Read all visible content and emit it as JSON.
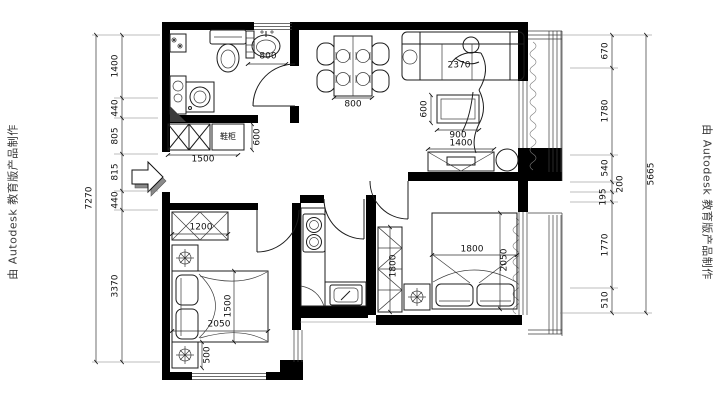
{
  "watermark": {
    "left": "由 Autodesk 教育版产品制作",
    "right": "由 Autodesk 教育版产品制作"
  },
  "dimensions": {
    "left_total": "7270",
    "left_chain": [
      "1400",
      "440",
      "805",
      "815",
      "440",
      "3370"
    ],
    "right_total": "5665",
    "right_chain": [
      "670",
      "1780",
      "540",
      "200",
      "195",
      "1770",
      "510"
    ],
    "interior": {
      "bath_basin_width": "800",
      "entry_cabinet_width": "1500",
      "entry_cabinet_depth": "600",
      "dining_table_width": "800",
      "sofa_length": "2370",
      "coffee_table_width": "900",
      "coffee_table_depth": "600",
      "tv_cabinet_width": "1400",
      "bedroom2_wardrobe_width": "1200",
      "bedroom2_bed_length": "2050",
      "bedroom2_bed_width": "1500",
      "bedroom2_nightstand_depth": "500",
      "master_wardrobe_length": "1800",
      "master_bed_width": "1800",
      "master_bed_length": "2050"
    }
  },
  "labels": {
    "entry_cabinet": "鞋柜"
  }
}
